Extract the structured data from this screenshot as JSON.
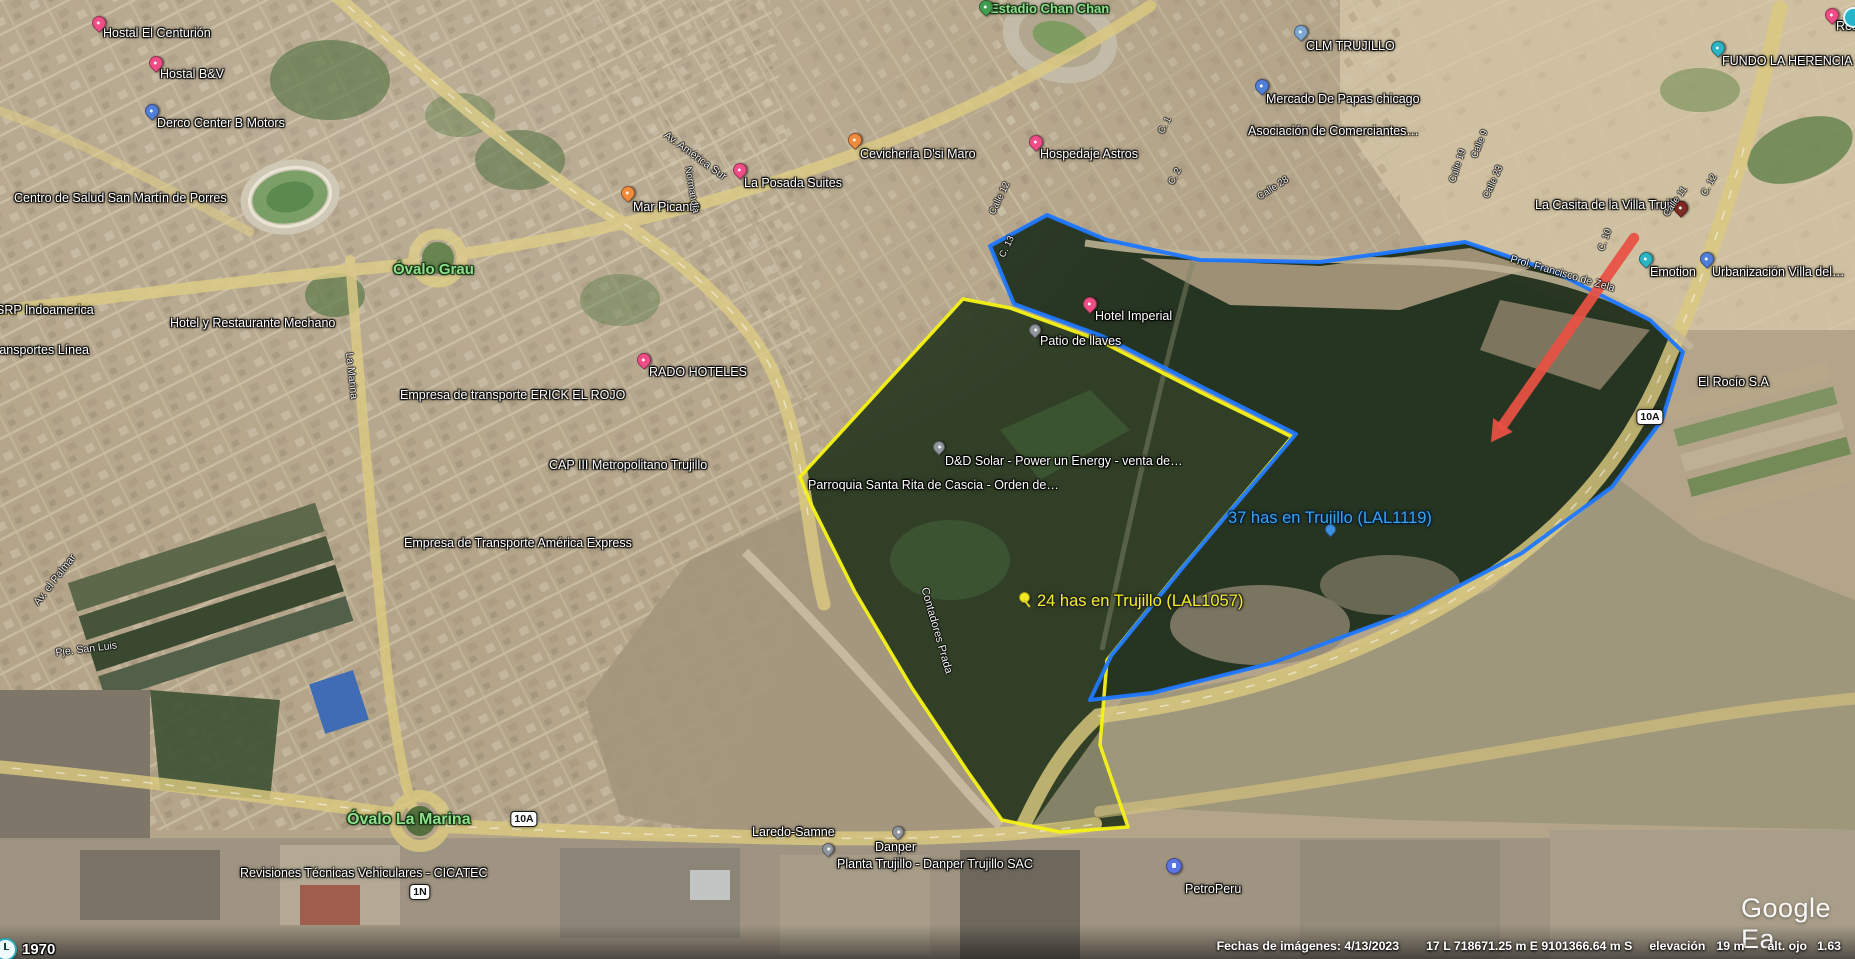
{
  "app": {
    "logo_text": "Google Ea",
    "time_badge": "1970"
  },
  "status_bar": {
    "dates": "Fechas de imágenes: 4/13/2023",
    "utm": "17 L 718671.25 m E 9101366.64 m S",
    "elevation_label": "elevación",
    "elevation_value": "19 m",
    "eye_alt_label": "alt. ojo",
    "eye_alt_value": "1.63"
  },
  "watermark": "Image © 2023 Airbus",
  "parcels": {
    "yellow": {
      "label": "24 has en Trujillo (LAL1057)",
      "label_x": 1037,
      "label_y": 592,
      "color": "#f5f216",
      "points": "963,299 800,477 812,506 855,592 912,688 968,772 1002,820 1060,832 1128,827 1100,745 1107,660 1180,570 1222,520 1292,437 1200,392 1098,340 1010,308"
    },
    "blue": {
      "label": "37 has en Trujillo (LAL1119)",
      "label_x": 1228,
      "label_y": 509,
      "color": "#1f78ff",
      "points": "990,246 1047,215 1107,240 1200,260 1320,262 1465,242 1555,272 1650,320 1683,352 1662,420 1612,487 1522,553 1407,613 1272,663 1152,693 1090,700 1111,656 1184,566 1226,516 1296,434 1204,388 1102,336 1014,304"
    }
  },
  "arrow": {
    "x1": 1634,
    "y1": 238,
    "x2": 1503,
    "y2": 425,
    "color": "#e95144"
  },
  "shields": [
    {
      "t": "10A",
      "x": 524,
      "y": 819
    },
    {
      "t": "1N",
      "x": 420,
      "y": 892
    },
    {
      "t": "10A",
      "x": 1650,
      "y": 417
    }
  ],
  "pins": [
    {
      "type": "pushpin",
      "x": 1019,
      "y": 592
    },
    {
      "type": "mini-blue",
      "x": 1325,
      "y": 524
    },
    {
      "type": "teal-circle",
      "x": 1843,
      "y": 7
    }
  ],
  "labels": [
    {
      "t": "Hostal El Centurión",
      "x": 103,
      "y": 27,
      "type": "poi",
      "pin": "pink",
      "px": 92,
      "py": 16
    },
    {
      "t": "Hostal B&V",
      "x": 160,
      "y": 68,
      "type": "poi",
      "pin": "pink",
      "px": 149,
      "py": 56
    },
    {
      "t": "Derco Center B Motors",
      "x": 157,
      "y": 117,
      "type": "poi",
      "pin": "blue",
      "px": 145,
      "py": 104
    },
    {
      "t": "Centro de Salud San Martín de Porres",
      "x": 14,
      "y": 192,
      "type": "poi"
    },
    {
      "t": "Óvalo Grau",
      "x": 393,
      "y": 262,
      "type": "green",
      "size": 15
    },
    {
      "t": "SRP Indoamerica",
      "x": -4,
      "y": 304,
      "type": "poi"
    },
    {
      "t": "Hotel y Restaurante Mechano",
      "x": 170,
      "y": 317,
      "type": "poi"
    },
    {
      "t": "Transportes Línea",
      "x": -12,
      "y": 344,
      "type": "poi"
    },
    {
      "t": "RADO HOTELES",
      "x": 649,
      "y": 366,
      "type": "poi",
      "pin": "pink",
      "px": 637,
      "py": 353
    },
    {
      "t": "Empresa de transporte ERICK EL ROJO",
      "x": 400,
      "y": 389,
      "type": "poi"
    },
    {
      "t": "CAP III Metropolitano Trujillo",
      "x": 549,
      "y": 459,
      "type": "poi"
    },
    {
      "t": "Empresa de Transporte América Express",
      "x": 404,
      "y": 537,
      "type": "poi"
    },
    {
      "t": "Mar Picante",
      "x": 633,
      "y": 201,
      "type": "poi",
      "pin": "orange",
      "px": 621,
      "py": 186
    },
    {
      "t": "La Posada Suites",
      "x": 744,
      "y": 177,
      "type": "poi",
      "pin": "pink",
      "px": 733,
      "py": 163
    },
    {
      "t": "Cevichería D'si Maro",
      "x": 860,
      "y": 148,
      "type": "poi",
      "pin": "orange",
      "px": 848,
      "py": 133
    },
    {
      "t": "Hospedaje Astros",
      "x": 1040,
      "y": 148,
      "type": "poi",
      "pin": "pink",
      "px": 1029,
      "py": 135
    },
    {
      "t": "Estadio Chan Chan",
      "x": 990,
      "y": 2,
      "type": "green",
      "size": 13,
      "pin": "green",
      "px": 979,
      "py": 0
    },
    {
      "t": "Hotel Imperial",
      "x": 1095,
      "y": 310,
      "type": "poi",
      "pin": "pink",
      "px": 1083,
      "py": 297
    },
    {
      "t": "Patio de llaves",
      "x": 1040,
      "y": 335,
      "type": "poi",
      "pin": "grey",
      "px": 1029,
      "py": 324
    },
    {
      "t": "D&D Solar - Power un Energy - venta de…",
      "x": 945,
      "y": 455,
      "type": "poi",
      "pin": "grey",
      "px": 933,
      "py": 441
    },
    {
      "t": "Parroquia Santa Rita de Cascia - Orden de…",
      "x": 808,
      "y": 479,
      "type": "poi"
    },
    {
      "t": "CLM TRUJILLO",
      "x": 1306,
      "y": 40,
      "type": "poi",
      "pin": "church",
      "px": 1294,
      "py": 25
    },
    {
      "t": "Mercado De Papas chicago",
      "x": 1266,
      "y": 93,
      "type": "poi",
      "pin": "blue",
      "px": 1255,
      "py": 79
    },
    {
      "t": "Asociación de Comerciantes…",
      "x": 1248,
      "y": 125,
      "type": "poi"
    },
    {
      "t": "FUNDO LA HERENCIA",
      "x": 1722,
      "y": 55,
      "type": "poi",
      "pin": "cyan",
      "px": 1711,
      "py": 41
    },
    {
      "t": "Res…",
      "x": 1836,
      "y": 20,
      "type": "poi",
      "pin": "pink",
      "px": 1825,
      "py": 8
    },
    {
      "t": "La Casita de la Villa Trujillo",
      "x": 1535,
      "y": 199,
      "type": "poi",
      "pin": "darkred",
      "px": 1674,
      "py": 201
    },
    {
      "t": "Emotion",
      "x": 1650,
      "y": 266,
      "type": "poi",
      "pin": "teal",
      "px": 1639,
      "py": 252
    },
    {
      "t": "Urbanización Villa del…",
      "x": 1712,
      "y": 266,
      "type": "poi",
      "pin": "blue",
      "px": 1700,
      "py": 252
    },
    {
      "t": "El Rocío S.A",
      "x": 1698,
      "y": 376,
      "type": "poi"
    },
    {
      "t": "Óvalo La Marina",
      "x": 347,
      "y": 811,
      "type": "green",
      "size": 16
    },
    {
      "t": "Revisiones Técnicas Vehiculares - CICATEC",
      "x": 240,
      "y": 867,
      "type": "poi"
    },
    {
      "t": "Laredo-Samne",
      "x": 752,
      "y": 826,
      "type": "poi"
    },
    {
      "t": "Danper",
      "x": 875,
      "y": 841,
      "type": "poi",
      "pin": "grey",
      "px": 892,
      "py": 826
    },
    {
      "t": "Planta Trujillo - Danper Trujillo SAC",
      "x": 837,
      "y": 858,
      "type": "poi",
      "pin": "grey",
      "px": 822,
      "py": 843
    },
    {
      "t": "PetroPeru",
      "x": 1185,
      "y": 883,
      "type": "poi",
      "pin": "fuel",
      "px": 1166,
      "py": 858
    },
    {
      "t": "Av. América Sur",
      "x": 668,
      "y": 130,
      "type": "street",
      "rot": 36,
      "size": 10.5
    },
    {
      "t": "Normandía",
      "x": 692,
      "y": 166,
      "type": "street",
      "rot": 80
    },
    {
      "t": "La Marina",
      "x": 354,
      "y": 352,
      "type": "street",
      "rot": 84,
      "size": 10.5
    },
    {
      "t": "Av. el Palmar",
      "x": 32,
      "y": 601,
      "type": "street",
      "rot": -52,
      "size": 10.5
    },
    {
      "t": "Pje. San Luis",
      "x": 55,
      "y": 648,
      "type": "street",
      "rot": -7,
      "size": 10.5
    },
    {
      "t": "Contadores Prada",
      "x": 930,
      "y": 586,
      "type": "street",
      "rot": 74,
      "size": 11
    },
    {
      "t": "C. 1",
      "x": 1157,
      "y": 131,
      "type": "street",
      "rot": -62
    },
    {
      "t": "C. 2",
      "x": 1167,
      "y": 182,
      "type": "street",
      "rot": -62
    },
    {
      "t": "Calle 12",
      "x": 988,
      "y": 212,
      "type": "street",
      "rot": -64
    },
    {
      "t": "C. 13",
      "x": 998,
      "y": 255,
      "type": "street",
      "rot": -64
    },
    {
      "t": "Calle 28",
      "x": 1256,
      "y": 194,
      "type": "street",
      "rot": -33
    },
    {
      "t": "Calle 9",
      "x": 1470,
      "y": 156,
      "type": "street",
      "rot": -68
    },
    {
      "t": "Calle 19",
      "x": 1448,
      "y": 181,
      "type": "street",
      "rot": -72
    },
    {
      "t": "Calle 23",
      "x": 1482,
      "y": 196,
      "type": "street",
      "rot": -66
    },
    {
      "t": "C. 10",
      "x": 1597,
      "y": 249,
      "type": "street",
      "rot": -70
    },
    {
      "t": "Calle 11",
      "x": 1662,
      "y": 213,
      "type": "street",
      "rot": -55
    },
    {
      "t": "C. 12",
      "x": 1700,
      "y": 193,
      "type": "street",
      "rot": -62
    },
    {
      "t": "Prol. Francisco de Zela",
      "x": 1512,
      "y": 254,
      "type": "street",
      "rot": 16,
      "size": 10.5
    }
  ]
}
